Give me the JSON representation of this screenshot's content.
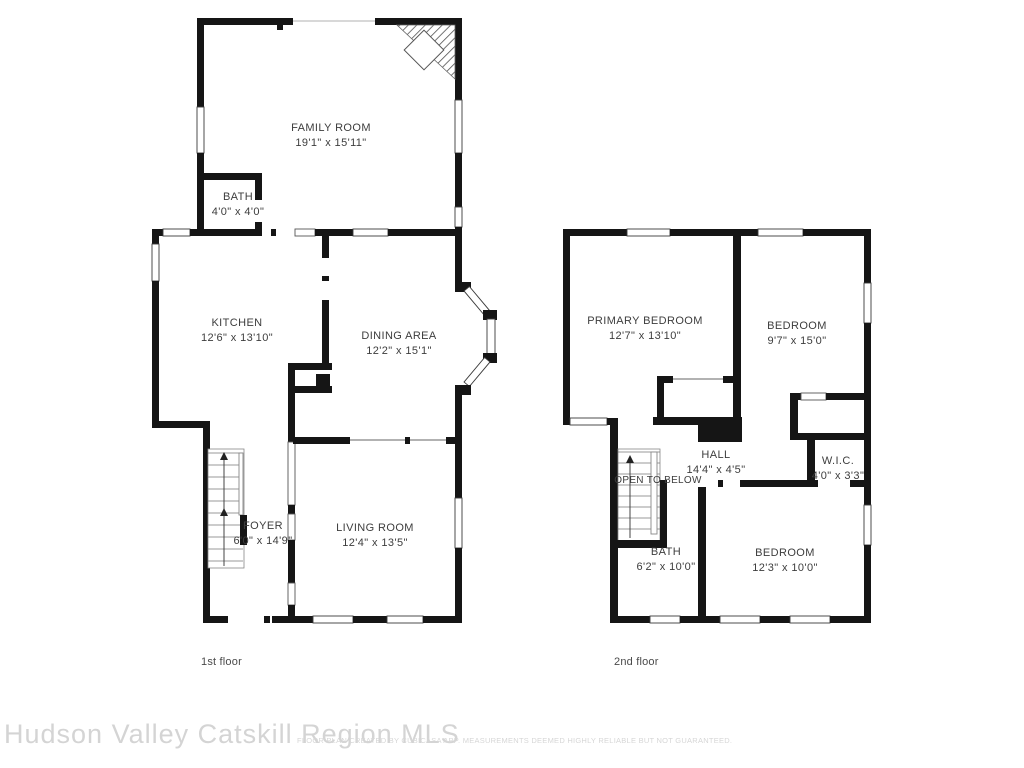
{
  "plan": {
    "first_floor": {
      "caption": "1st floor",
      "rooms": {
        "family": {
          "label": "FAMILY ROOM",
          "dims": "19'1\" x 15'11\""
        },
        "bath": {
          "label": "BATH",
          "dims": "4'0\" x 4'0\""
        },
        "kitchen": {
          "label": "KITCHEN",
          "dims": "12'6\" x 13'10\""
        },
        "dining": {
          "label": "DINING AREA",
          "dims": "12'2\" x 15'1\""
        },
        "foyer": {
          "label": "FOYER",
          "dims": "6'0\" x 14'9\""
        },
        "living": {
          "label": "LIVING ROOM",
          "dims": "12'4\" x 13'5\""
        }
      }
    },
    "second_floor": {
      "caption": "2nd floor",
      "rooms": {
        "primary": {
          "label": "PRIMARY BEDROOM",
          "dims": "12'7\" x 13'10\""
        },
        "bedroom2": {
          "label": "BEDROOM",
          "dims": "9'7\" x 15'0\""
        },
        "hall": {
          "label": "HALL",
          "dims": "14'4\" x 4'5\""
        },
        "wic": {
          "label": "W.I.C.",
          "dims": "4'0\" x 3'3\""
        },
        "open_below": {
          "label": "OPEN TO BELOW"
        },
        "bath": {
          "label": "BATH",
          "dims": "6'2\" x 10'0\""
        },
        "bedroom3": {
          "label": "BEDROOM",
          "dims": "12'3\" x 10'0\""
        }
      }
    },
    "watermark": "Hudson Valley Catskill Region MLS",
    "disclaimer": "FLOOR PLAN CREATED BY CUBICASA APP. MEASUREMENTS DEEMED HIGHLY RELIABLE BUT NOT GUARANTEED.",
    "colors": {
      "wall": "#151515",
      "room_text": "#3d3d3d",
      "watermark_text": "#d4d4d4"
    }
  }
}
